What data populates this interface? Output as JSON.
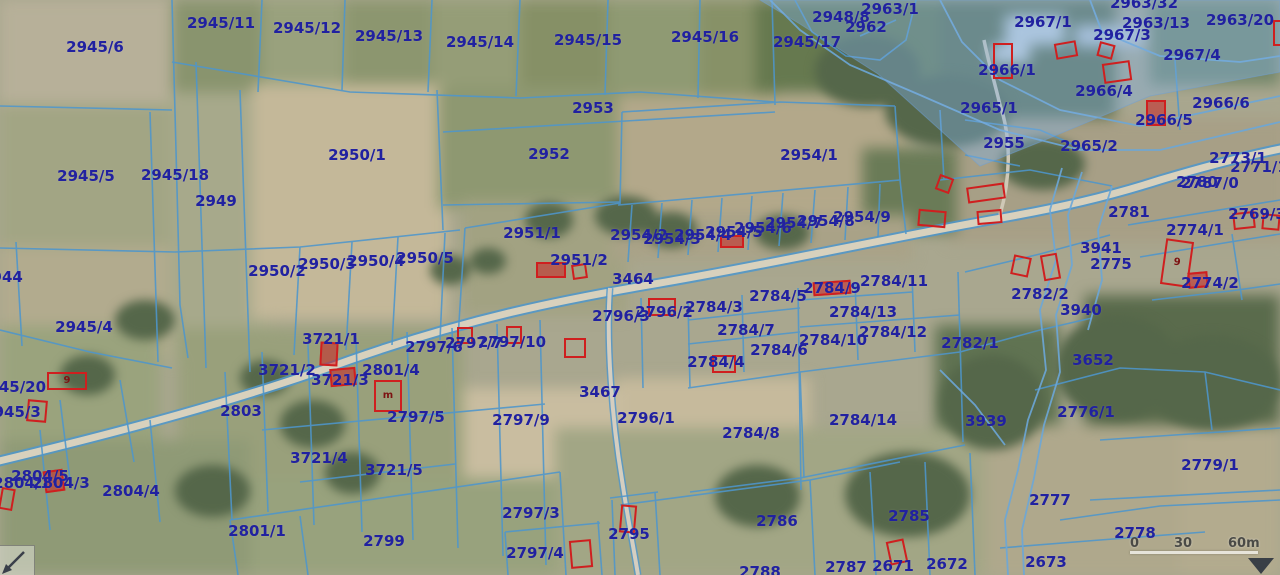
{
  "map": {
    "colors": {
      "label": "#2121a0",
      "boundary": "#4e96cc",
      "building": "#cf1f1f",
      "road_fill": "#d8d1bd",
      "highlight_overlay": "#7fb2e5"
    },
    "parcel_labels": [
      {
        "t": "2945/6",
        "x": 95,
        "y": 47
      },
      {
        "t": "2945/11",
        "x": 221,
        "y": 23
      },
      {
        "t": "2945/12",
        "x": 307,
        "y": 28
      },
      {
        "t": "2945/13",
        "x": 389,
        "y": 36
      },
      {
        "t": "2945/14",
        "x": 480,
        "y": 42
      },
      {
        "t": "2945/15",
        "x": 588,
        "y": 40
      },
      {
        "t": "2945/16",
        "x": 705,
        "y": 37
      },
      {
        "t": "2945/17",
        "x": 807,
        "y": 42
      },
      {
        "t": "2948/8",
        "x": 841,
        "y": 17
      },
      {
        "t": "2962",
        "x": 866,
        "y": 27
      },
      {
        "t": "2963/1",
        "x": 890,
        "y": 9
      },
      {
        "t": "2963/32",
        "x": 1144,
        "y": 3
      },
      {
        "t": "2967/1",
        "x": 1043,
        "y": 22
      },
      {
        "t": "2963/13",
        "x": 1156,
        "y": 23
      },
      {
        "t": "2963/20",
        "x": 1240,
        "y": 20
      },
      {
        "t": "2967/3",
        "x": 1122,
        "y": 35
      },
      {
        "t": "2967/4",
        "x": 1192,
        "y": 55
      },
      {
        "t": "2966/1",
        "x": 1007,
        "y": 70
      },
      {
        "t": "2966/4",
        "x": 1104,
        "y": 91
      },
      {
        "t": "2966/6",
        "x": 1221,
        "y": 103
      },
      {
        "t": "2966/5",
        "x": 1164,
        "y": 120
      },
      {
        "t": "2965/1",
        "x": 989,
        "y": 108
      },
      {
        "t": "2955",
        "x": 1004,
        "y": 143
      },
      {
        "t": "2965/2",
        "x": 1089,
        "y": 146
      },
      {
        "t": "2953",
        "x": 593,
        "y": 108
      },
      {
        "t": "2952",
        "x": 549,
        "y": 154
      },
      {
        "t": "2950/1",
        "x": 357,
        "y": 155
      },
      {
        "t": "2954/1",
        "x": 809,
        "y": 155
      },
      {
        "t": "2945/5",
        "x": 86,
        "y": 176
      },
      {
        "t": "2945/18",
        "x": 175,
        "y": 175
      },
      {
        "t": "2949",
        "x": 216,
        "y": 201
      },
      {
        "t": "2944",
        "x": 2,
        "y": 277
      },
      {
        "t": "2773/1",
        "x": 1238,
        "y": 158
      },
      {
        "t": "2771/1",
        "x": 1259,
        "y": 167
      },
      {
        "t": "2780",
        "x": 1197,
        "y": 182
      },
      {
        "t": "2787/0",
        "x": 1210,
        "y": 183
      },
      {
        "t": "2781",
        "x": 1129,
        "y": 212
      },
      {
        "t": "2769/3",
        "x": 1257,
        "y": 214
      },
      {
        "t": "2774/1",
        "x": 1195,
        "y": 230
      },
      {
        "t": "3941",
        "x": 1101,
        "y": 248
      },
      {
        "t": "2775",
        "x": 1111,
        "y": 264
      },
      {
        "t": "2774/2",
        "x": 1210,
        "y": 283
      },
      {
        "t": "2782/2",
        "x": 1040,
        "y": 294
      },
      {
        "t": "3940",
        "x": 1081,
        "y": 310
      },
      {
        "t": "2950/2",
        "x": 277,
        "y": 271
      },
      {
        "t": "2950/3",
        "x": 327,
        "y": 264
      },
      {
        "t": "2950/4",
        "x": 376,
        "y": 261
      },
      {
        "t": "2950/5",
        "x": 425,
        "y": 258
      },
      {
        "t": "2951/1",
        "x": 532,
        "y": 233
      },
      {
        "t": "2951/2",
        "x": 579,
        "y": 260
      },
      {
        "t": "3464",
        "x": 633,
        "y": 279
      },
      {
        "t": "2954/2",
        "x": 639,
        "y": 235
      },
      {
        "t": "2954/3",
        "x": 672,
        "y": 239
      },
      {
        "t": "2954/4",
        "x": 703,
        "y": 235
      },
      {
        "t": "2954/5",
        "x": 734,
        "y": 232
      },
      {
        "t": "2954/6",
        "x": 763,
        "y": 228
      },
      {
        "t": "2954/7",
        "x": 794,
        "y": 223
      },
      {
        "t": "2954/8",
        "x": 826,
        "y": 221
      },
      {
        "t": "2954/9",
        "x": 862,
        "y": 217
      },
      {
        "t": "2796/3",
        "x": 621,
        "y": 316
      },
      {
        "t": "2796/2",
        "x": 664,
        "y": 312
      },
      {
        "t": "2784/3",
        "x": 714,
        "y": 307
      },
      {
        "t": "2784/5",
        "x": 778,
        "y": 296
      },
      {
        "t": "2784/9",
        "x": 832,
        "y": 288
      },
      {
        "t": "2784/11",
        "x": 894,
        "y": 281
      },
      {
        "t": "2784/13",
        "x": 863,
        "y": 312
      },
      {
        "t": "2784/7",
        "x": 746,
        "y": 330
      },
      {
        "t": "2784/12",
        "x": 893,
        "y": 332
      },
      {
        "t": "2784/10",
        "x": 833,
        "y": 340
      },
      {
        "t": "2784/6",
        "x": 779,
        "y": 350
      },
      {
        "t": "2784/4",
        "x": 716,
        "y": 362
      },
      {
        "t": "2782/1",
        "x": 970,
        "y": 343
      },
      {
        "t": "3652",
        "x": 1093,
        "y": 360
      },
      {
        "t": "3721/1",
        "x": 331,
        "y": 339
      },
      {
        "t": "3721/2",
        "x": 287,
        "y": 370
      },
      {
        "t": "3721/3",
        "x": 340,
        "y": 380
      },
      {
        "t": "2801/4",
        "x": 391,
        "y": 370
      },
      {
        "t": "2797/6",
        "x": 434,
        "y": 347
      },
      {
        "t": "2797/7",
        "x": 474,
        "y": 343
      },
      {
        "t": "2797/10",
        "x": 512,
        "y": 342
      },
      {
        "t": "2945/20",
        "x": 12,
        "y": 387
      },
      {
        "t": "2945/3",
        "x": 12,
        "y": 412
      },
      {
        "t": "2803",
        "x": 241,
        "y": 411
      },
      {
        "t": "2945/4",
        "x": 84,
        "y": 327
      },
      {
        "t": "3467",
        "x": 600,
        "y": 392
      },
      {
        "t": "2797/5",
        "x": 416,
        "y": 417
      },
      {
        "t": "2797/9",
        "x": 521,
        "y": 420
      },
      {
        "t": "2796/1",
        "x": 646,
        "y": 418
      },
      {
        "t": "2784/8",
        "x": 751,
        "y": 433
      },
      {
        "t": "2784/14",
        "x": 863,
        "y": 420
      },
      {
        "t": "3721/4",
        "x": 319,
        "y": 458
      },
      {
        "t": "3721/5",
        "x": 394,
        "y": 470
      },
      {
        "t": "2804/5",
        "x": 40,
        "y": 476
      },
      {
        "t": "2804/1",
        "x": 22,
        "y": 483
      },
      {
        "t": "2804/3",
        "x": 61,
        "y": 483
      },
      {
        "t": "2804/4",
        "x": 131,
        "y": 491
      },
      {
        "t": "2801/1",
        "x": 257,
        "y": 531
      },
      {
        "t": "2799",
        "x": 384,
        "y": 541
      },
      {
        "t": "2797/3",
        "x": 531,
        "y": 513
      },
      {
        "t": "2797/4",
        "x": 535,
        "y": 553
      },
      {
        "t": "2795",
        "x": 629,
        "y": 534
      },
      {
        "t": "2786",
        "x": 777,
        "y": 521
      },
      {
        "t": "2785",
        "x": 909,
        "y": 516
      },
      {
        "t": "2788",
        "x": 760,
        "y": 572
      },
      {
        "t": "2787",
        "x": 846,
        "y": 567
      },
      {
        "t": "2671",
        "x": 893,
        "y": 566
      },
      {
        "t": "2672",
        "x": 947,
        "y": 564
      },
      {
        "t": "2776/1",
        "x": 1086,
        "y": 412
      },
      {
        "t": "3939",
        "x": 986,
        "y": 421
      },
      {
        "t": "2779/1",
        "x": 1210,
        "y": 465
      },
      {
        "t": "2777",
        "x": 1050,
        "y": 500
      },
      {
        "t": "2778",
        "x": 1135,
        "y": 533
      },
      {
        "t": "2673",
        "x": 1046,
        "y": 562
      }
    ],
    "buildings": [
      {
        "x": 47,
        "y": 372,
        "w": 40,
        "h": 18,
        "r": 0,
        "t": "9"
      },
      {
        "x": 27,
        "y": 400,
        "w": 20,
        "h": 22,
        "r": 5
      },
      {
        "x": 44,
        "y": 470,
        "w": 20,
        "h": 22,
        "r": -8,
        "f": true
      },
      {
        "x": 0,
        "y": 488,
        "w": 14,
        "h": 22,
        "r": 10
      },
      {
        "x": 320,
        "y": 342,
        "w": 18,
        "h": 24,
        "r": 3,
        "f": true
      },
      {
        "x": 330,
        "y": 368,
        "w": 26,
        "h": 18,
        "r": -5,
        "f": true
      },
      {
        "x": 374,
        "y": 380,
        "w": 28,
        "h": 32,
        "r": 0,
        "t": "m"
      },
      {
        "x": 457,
        "y": 327,
        "w": 16,
        "h": 17,
        "r": 0
      },
      {
        "x": 506,
        "y": 326,
        "w": 16,
        "h": 18,
        "r": 0
      },
      {
        "x": 564,
        "y": 338,
        "w": 22,
        "h": 20,
        "r": 0
      },
      {
        "x": 536,
        "y": 262,
        "w": 30,
        "h": 16,
        "r": 0,
        "f": true
      },
      {
        "x": 572,
        "y": 264,
        "w": 15,
        "h": 15,
        "r": -8
      },
      {
        "x": 720,
        "y": 235,
        "w": 24,
        "h": 13,
        "r": 0,
        "f": true
      },
      {
        "x": 648,
        "y": 298,
        "w": 28,
        "h": 18,
        "r": 0
      },
      {
        "x": 813,
        "y": 281,
        "w": 38,
        "h": 14,
        "r": -4,
        "f": true
      },
      {
        "x": 712,
        "y": 355,
        "w": 24,
        "h": 18,
        "r": 0
      },
      {
        "x": 937,
        "y": 176,
        "w": 15,
        "h": 16,
        "r": 20
      },
      {
        "x": 918,
        "y": 210,
        "w": 28,
        "h": 17,
        "r": 5
      },
      {
        "x": 967,
        "y": 185,
        "w": 38,
        "h": 16,
        "r": -8
      },
      {
        "x": 977,
        "y": 210,
        "w": 25,
        "h": 14,
        "r": -5
      },
      {
        "x": 1012,
        "y": 256,
        "w": 18,
        "h": 20,
        "r": 12
      },
      {
        "x": 1042,
        "y": 254,
        "w": 17,
        "h": 26,
        "r": -10
      },
      {
        "x": 1163,
        "y": 240,
        "w": 28,
        "h": 46,
        "r": 8,
        "t": "9"
      },
      {
        "x": 1188,
        "y": 272,
        "w": 20,
        "h": 16,
        "r": -5,
        "f": true
      },
      {
        "x": 1233,
        "y": 212,
        "w": 22,
        "h": 17,
        "r": -6
      },
      {
        "x": 1262,
        "y": 214,
        "w": 18,
        "h": 16,
        "r": 5
      },
      {
        "x": 1146,
        "y": 100,
        "w": 20,
        "h": 26,
        "r": 0,
        "f": true
      },
      {
        "x": 1055,
        "y": 42,
        "w": 22,
        "h": 16,
        "r": -10
      },
      {
        "x": 1098,
        "y": 43,
        "w": 16,
        "h": 15,
        "r": 15
      },
      {
        "x": 1103,
        "y": 62,
        "w": 28,
        "h": 20,
        "r": -8
      },
      {
        "x": 993,
        "y": 43,
        "w": 20,
        "h": 36,
        "r": 0
      },
      {
        "x": 1273,
        "y": 20,
        "w": 10,
        "h": 26,
        "r": 0
      },
      {
        "x": 888,
        "y": 540,
        "w": 18,
        "h": 24,
        "r": -12
      },
      {
        "x": 620,
        "y": 505,
        "w": 16,
        "h": 28,
        "r": 5
      },
      {
        "x": 570,
        "y": 540,
        "w": 22,
        "h": 28,
        "r": -5
      }
    ],
    "scale_bar": {
      "t0": "0",
      "t30": "30",
      "t60": "60m"
    }
  }
}
